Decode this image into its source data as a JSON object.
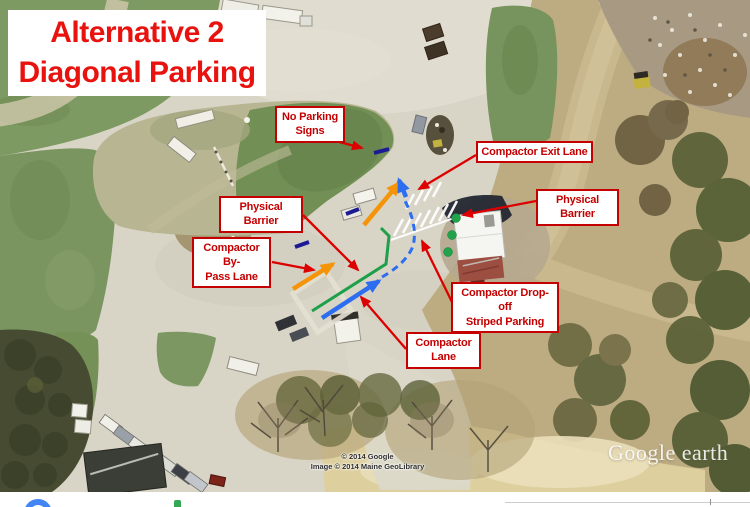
{
  "slide": {
    "title_line1": "Alternative 2",
    "title_line2": "Diagonal Parking"
  },
  "annotations": {
    "no_parking_signs": "No Parking\nSigns",
    "compactor_exit_lane": "Compactor Exit Lane",
    "physical_barrier_right": "Physical Barrier",
    "physical_barrier_left": "Physical Barrier",
    "compactor_bypass_lane": "Compactor By-\nPass Lane",
    "compactor_dropoff_striped_parking": "Compactor Drop-off\nStriped Parking",
    "compactor_lane": "Compactor\nLane"
  },
  "map_credits": {
    "line1": "© 2014 Google",
    "line2": "Image © 2014 Maine GeoLibrary",
    "watermark": "Google earth"
  },
  "colors": {
    "annotation_red": "#c40000",
    "bypass_lane_orange": "#f59408",
    "compactor_lane_blue": "#2d6ef0",
    "barrier_green": "#1da049",
    "no_parking_navy": "#1b1b96"
  }
}
